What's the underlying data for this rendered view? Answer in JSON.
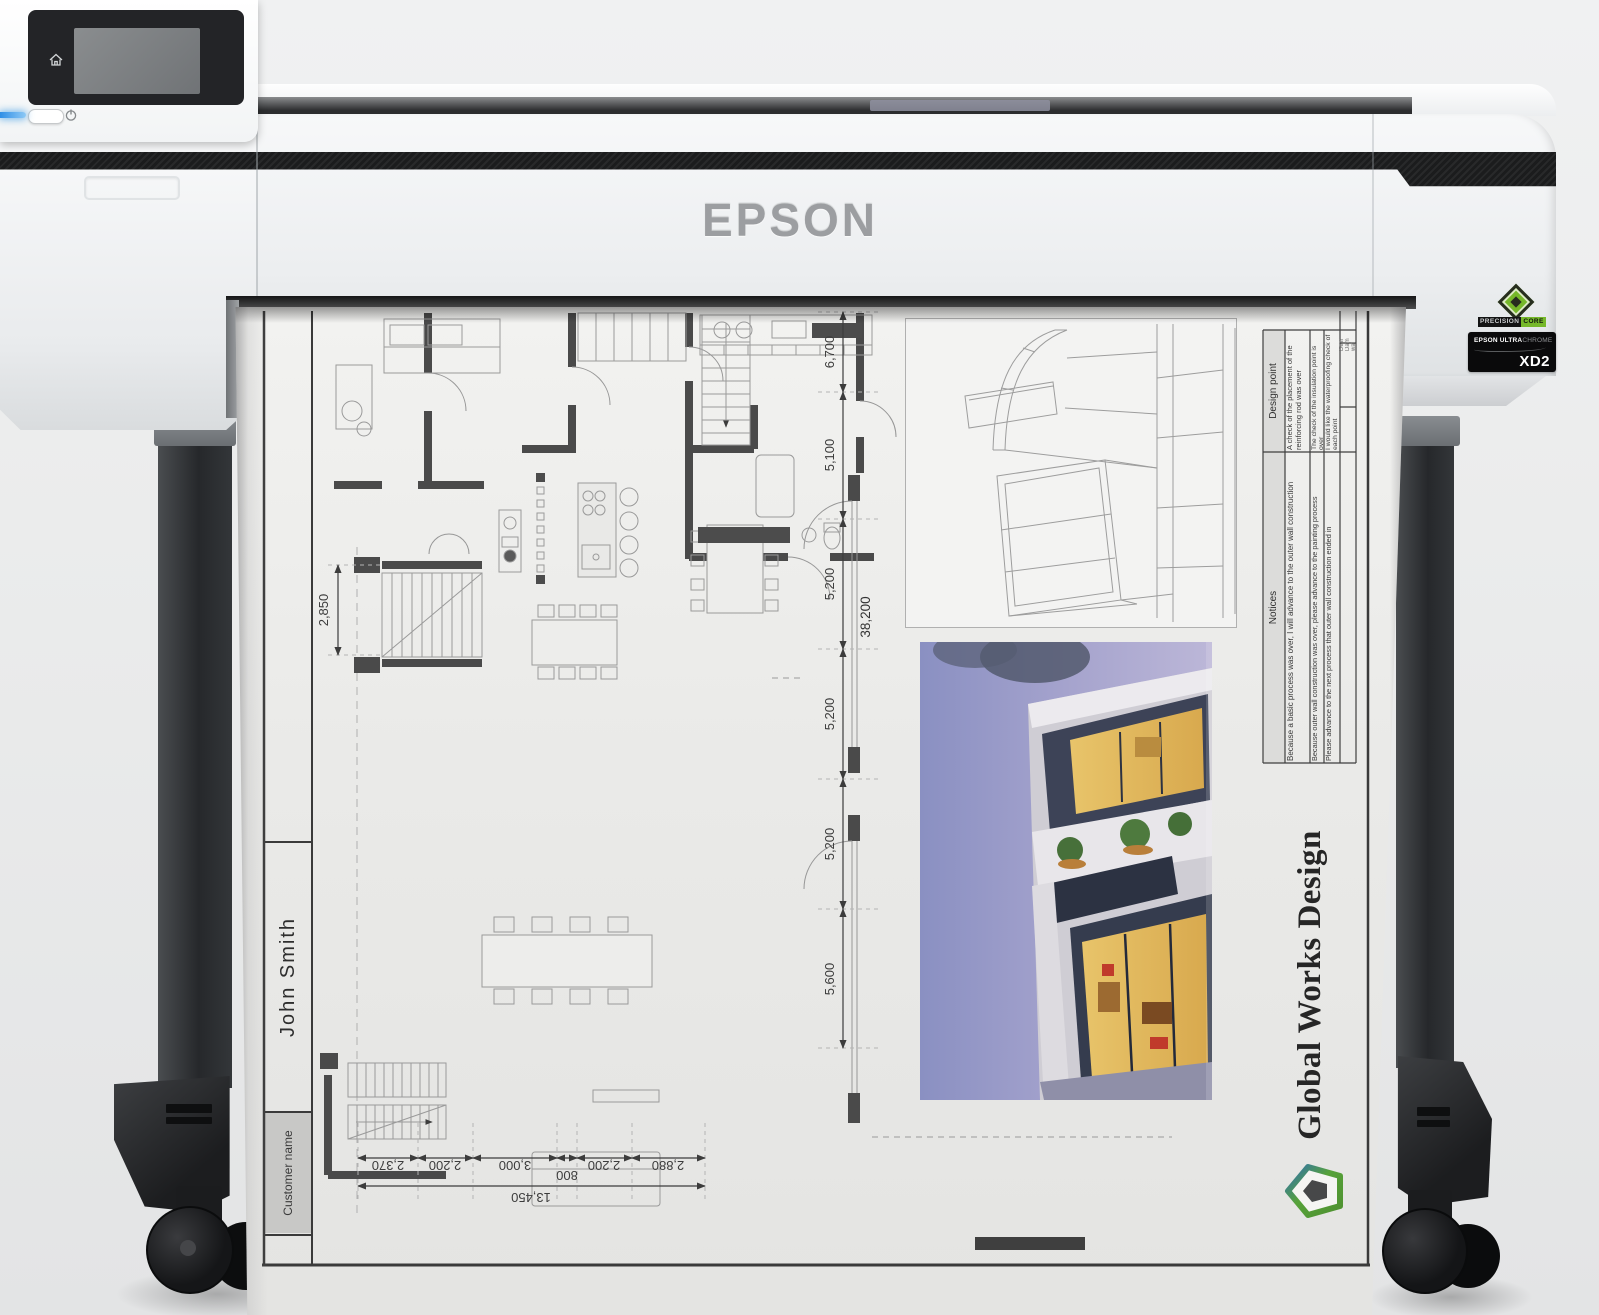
{
  "printer": {
    "brand": "EPSON",
    "badges": {
      "precisioncore_1": "PRECISION",
      "precisioncore_2": "CORE",
      "ultrachrome_brand": "EPSON ULTRA",
      "ultrachrome_suffix": "CHROME",
      "ultrachrome_model": "XD2"
    }
  },
  "print": {
    "title_block": {
      "customer_label": "Customer name",
      "customer_name": "John Smith"
    },
    "company": "Global Works Design",
    "table": {
      "design_point_header": "Design point",
      "design_points": [
        "A check of the placement of the reinforcing rod was over",
        "The check of the insulation point is over",
        "I would like the waterproofing check of each point"
      ],
      "notices_header": "Notices",
      "notices": [
        "Because a basic process was over, I will advance to the outer wall construction",
        "Because outer wall construction was over, please advance to the painting process",
        "Please advance to the next process that outer wall construction ended in"
      ],
      "partial_cells": [
        "Desi",
        "Dam",
        "wal"
      ]
    },
    "dimensions": {
      "horizontal_segments": [
        "2,370",
        "2,200",
        "3,000",
        "800",
        "2,200",
        "2,880"
      ],
      "horizontal_total": "13,450",
      "vertical_segments": [
        "6,700",
        "5,100",
        "5,200",
        "5,200",
        "5,200",
        "5,600"
      ],
      "vertical_total": "38,200",
      "stair_width": "2,850"
    }
  },
  "colors": {
    "accent_green": "#76b82a",
    "led_blue": "#4aa0e8",
    "stripe_black": "#1b1c1d"
  }
}
